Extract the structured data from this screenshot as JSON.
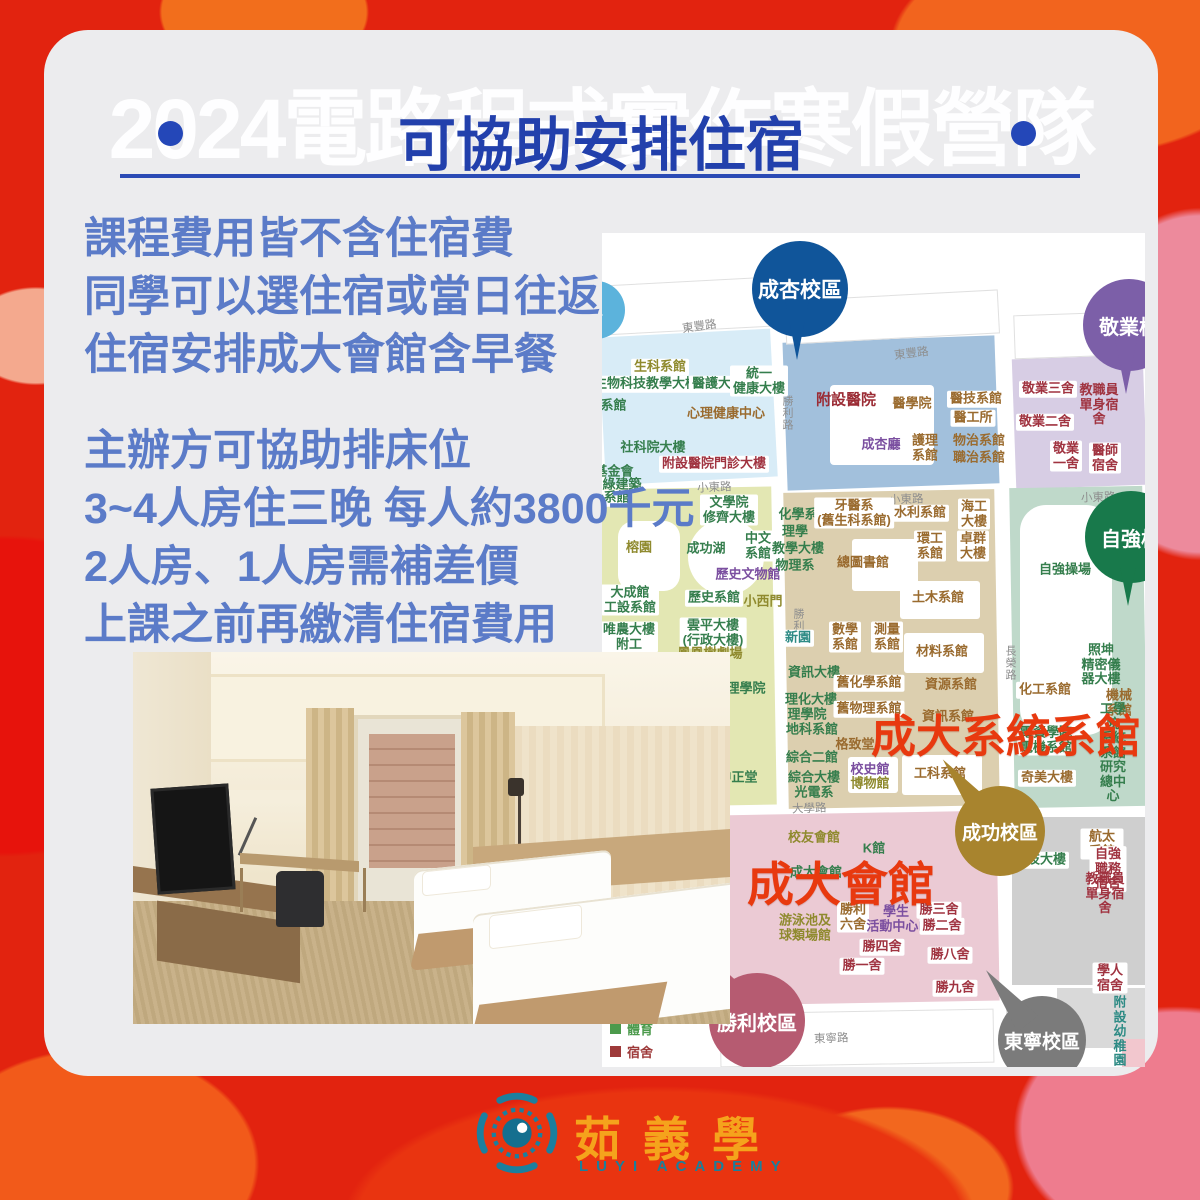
{
  "header": {
    "watermark": "2024電路程式實作寒假營隊",
    "title": "可協助安排住宿"
  },
  "info": {
    "para1": [
      "課程費用皆不含住宿費",
      "同學可以選住宿或當日往返",
      "住宿安排成大會館含早餐"
    ],
    "para2": [
      "主辦方可協助排床位",
      "3~4人房住三晚  每人約3800千元",
      "2人房、1人房需補差價",
      "上課之前再繳清住宿費用"
    ]
  },
  "logo": {
    "name": "茹義學",
    "subtitle": "LUYI ACADEMY",
    "accent": "#F5A31C",
    "teal": "#1B7F9C"
  },
  "colors": {
    "card_bg": "#ECECEE",
    "title_blue": "#2240AC",
    "body_blue": "#5B7BC8",
    "highlight_red": "#E8390F",
    "background_red": "#E2230F"
  },
  "map": {
    "palette": {
      "green": "#357E4D",
      "olive": "#8F8A2E",
      "brown": "#9A6B2F",
      "darkred": "#A03340",
      "purple": "#7B4FA0",
      "teal": "#2E8B85",
      "hospital": "#9B2C35"
    },
    "areas": [
      {
        "x": 0,
        "y": 100,
        "w": 172,
        "h": 148,
        "color": "#D8ECF7",
        "rot": -3
      },
      {
        "x": 183,
        "y": 106,
        "w": 212,
        "h": 148,
        "color": "#A2C0DC",
        "rot": -2
      },
      {
        "x": 412,
        "y": 124,
        "w": 131,
        "h": 130,
        "color": "#D7CDE4",
        "rot": -2
      },
      {
        "x": 0,
        "y": 255,
        "w": 172,
        "h": 318,
        "color": "#E3E7B3",
        "rot": -1
      },
      {
        "x": 184,
        "y": 258,
        "w": 211,
        "h": 316,
        "color": "#DCCFAF",
        "rot": -1
      },
      {
        "x": 410,
        "y": 254,
        "w": 133,
        "h": 320,
        "color": "#BFD9CA",
        "rot": -1
      },
      {
        "x": 410,
        "y": 584,
        "w": 133,
        "h": 168,
        "color": "#CFCFCF",
        "rot": 0
      },
      {
        "x": 116,
        "y": 580,
        "w": 280,
        "h": 190,
        "color": "#EBCAD4",
        "rot": -1
      },
      {
        "x": 455,
        "y": 755,
        "w": 88,
        "h": 60,
        "color": "#D9D9D9",
        "rot": 0
      },
      {
        "x": 520,
        "y": 806,
        "w": 23,
        "h": 28,
        "color": "#F2C7CE",
        "rot": 0
      }
    ],
    "outlines": [
      {
        "x": 0,
        "y": 48,
        "w": 170,
        "h": 48,
        "rot": -3
      },
      {
        "x": 183,
        "y": 62,
        "w": 212,
        "h": 42,
        "rot": -3
      },
      {
        "x": 412,
        "y": 80,
        "w": 131,
        "h": 42,
        "rot": -2
      },
      {
        "x": 118,
        "y": 778,
        "w": 272,
        "h": 52,
        "rot": -1
      },
      {
        "x": 404,
        "y": 772,
        "w": 42,
        "h": 44,
        "rot": 0
      }
    ],
    "shapes": [
      {
        "x": 228,
        "y": 152,
        "w": 104,
        "h": 80,
        "r": 4
      },
      {
        "x": 16,
        "y": 288,
        "w": 62,
        "h": 70,
        "r": 16
      },
      {
        "x": 86,
        "y": 286,
        "w": 76,
        "h": 76,
        "r": 40
      },
      {
        "x": 418,
        "y": 272,
        "w": 92,
        "h": 230,
        "r": 26
      },
      {
        "x": 250,
        "y": 306,
        "w": 66,
        "h": 52,
        "r": 3
      },
      {
        "x": 246,
        "y": 524,
        "w": 50,
        "h": 36,
        "r": 3
      },
      {
        "x": 298,
        "y": 348,
        "w": 80,
        "h": 38,
        "r": 3
      },
      {
        "x": 302,
        "y": 400,
        "w": 80,
        "h": 40,
        "r": 3
      },
      {
        "x": 300,
        "y": 522,
        "w": 80,
        "h": 40,
        "r": 3
      }
    ],
    "roads": [
      {
        "t": "東豐路",
        "x": 80,
        "y": 85,
        "rot": -8
      },
      {
        "t": "東豐路",
        "x": 292,
        "y": 112,
        "rot": -7
      },
      {
        "t": "小東路",
        "x": 95,
        "y": 246,
        "rot": -3
      },
      {
        "t": "小東路",
        "x": 287,
        "y": 258,
        "rot": -2
      },
      {
        "t": "小東路",
        "x": 479,
        "y": 256,
        "rot": -2
      },
      {
        "t": "勝利路",
        "x": 177,
        "y": 162,
        "vert": true
      },
      {
        "t": "勝利路",
        "x": 188,
        "y": 375,
        "vert": true
      },
      {
        "t": "長榮路",
        "x": 400,
        "y": 412,
        "vert": true
      },
      {
        "t": "大學路",
        "x": 190,
        "y": 567,
        "rot": -2
      },
      {
        "t": "東寧路",
        "x": 212,
        "y": 797,
        "rot": -2
      }
    ],
    "pins": [
      {
        "label": "區",
        "x": -6,
        "y": 77,
        "r": 29,
        "color": "#5CB3DC",
        "tail": "none",
        "fs": 14
      },
      {
        "label": "成杏校區",
        "x": 198,
        "y": 56,
        "r": 48,
        "color": "#10559A",
        "tail": "down",
        "fs": 21
      },
      {
        "label": "敬業校",
        "x": 527,
        "y": 92,
        "r": 46,
        "color": "#7C5FA8",
        "tail": "down",
        "fs": 20
      },
      {
        "label": "自強校",
        "x": 529,
        "y": 304,
        "r": 46,
        "color": "#18794B",
        "tail": "down",
        "fs": 20
      },
      {
        "label": "成功校區",
        "x": 398,
        "y": 598,
        "r": 45,
        "color": "#A8842E",
        "tail": "upleft",
        "fs": 19
      },
      {
        "label": "勝利校區",
        "x": 155,
        "y": 788,
        "r": 48,
        "color": "#B65B71",
        "tail": "upleft",
        "fs": 20
      },
      {
        "label": "東寧校區",
        "x": 440,
        "y": 807,
        "r": 44,
        "color": "#7B7B7B",
        "tail": "upleft",
        "fs": 19
      }
    ],
    "overlays": [
      {
        "text": "成大系統系館",
        "x": 269,
        "y": 467,
        "size": 45
      },
      {
        "text": "成大會館",
        "x": 145,
        "y": 613,
        "size": 47
      }
    ],
    "legend": {
      "x": 8,
      "y": 786,
      "items": [
        {
          "label": "體育",
          "color": "#4C9A4C"
        },
        {
          "label": "宿舍",
          "color": "#9E3A3A"
        },
        {
          "label": "其他",
          "color": "#2E8B85"
        }
      ]
    },
    "labels": [
      {
        "t": "生科系館",
        "x": 58,
        "y": 134,
        "c": "olive",
        "bg": true
      },
      {
        "t": "生物科技教學大樓",
        "x": 44,
        "y": 151,
        "c": "green",
        "bg": true
      },
      {
        "t": "醫護大樓",
        "x": 116,
        "y": 151,
        "c": "green",
        "bg": true
      },
      {
        "t": "統一\n健康大樓",
        "x": 157,
        "y": 148,
        "c": "green",
        "bg": true
      },
      {
        "t": "文系館",
        "x": 5,
        "y": 173,
        "c": "green",
        "bg": false
      },
      {
        "t": "心理健康中心",
        "x": 124,
        "y": 181,
        "c": "brown",
        "bg": false
      },
      {
        "t": "社科院大樓",
        "x": 51,
        "y": 215,
        "c": "green",
        "bg": false
      },
      {
        "t": "附設醫院門診大樓",
        "x": 112,
        "y": 231,
        "c": "darkred",
        "bg": true
      },
      {
        "t": "基金會",
        "x": 12,
        "y": 239,
        "c": "green",
        "bg": false
      },
      {
        "t": "綠建築",
        "x": 20,
        "y": 252,
        "c": "green",
        "bg": false
      },
      {
        "t": "附設醫院",
        "x": 244,
        "y": 168,
        "c": "hospital",
        "bg": false,
        "big": true
      },
      {
        "t": "醫學院",
        "x": 310,
        "y": 171,
        "c": "brown",
        "bg": false
      },
      {
        "t": "醫技系館",
        "x": 374,
        "y": 166,
        "c": "brown",
        "bg": true
      },
      {
        "t": "醫工所",
        "x": 371,
        "y": 185,
        "c": "brown",
        "bg": true
      },
      {
        "t": "成杏廳",
        "x": 279,
        "y": 212,
        "c": "purple",
        "bg": false
      },
      {
        "t": "護理\n系館",
        "x": 323,
        "y": 215,
        "c": "brown",
        "bg": false
      },
      {
        "t": "物治系館",
        "x": 377,
        "y": 208,
        "c": "brown",
        "bg": false
      },
      {
        "t": "職治系館",
        "x": 377,
        "y": 225,
        "c": "brown",
        "bg": false
      },
      {
        "t": "敬業三舍",
        "x": 446,
        "y": 156,
        "c": "darkred",
        "bg": true
      },
      {
        "t": "教職員單身宿舍",
        "x": 497,
        "y": 172,
        "c": "darkred",
        "bg": false
      },
      {
        "t": "敬業二舍",
        "x": 443,
        "y": 189,
        "c": "darkred",
        "bg": true
      },
      {
        "t": "敬業\n一舍",
        "x": 464,
        "y": 223,
        "c": "darkred",
        "bg": true
      },
      {
        "t": "醫師\n宿舍",
        "x": 503,
        "y": 225,
        "c": "darkred",
        "bg": true
      },
      {
        "t": "計系館",
        "x": 8,
        "y": 265,
        "c": "green",
        "bg": true
      },
      {
        "t": "文學院\n修齊大樓",
        "x": 127,
        "y": 277,
        "c": "green",
        "bg": true
      },
      {
        "t": "榕園",
        "x": 37,
        "y": 315,
        "c": "olive",
        "bg": false
      },
      {
        "t": "成功湖",
        "x": 104,
        "y": 316,
        "c": "green",
        "bg": false
      },
      {
        "t": "中文\n系館",
        "x": 156,
        "y": 313,
        "c": "green",
        "bg": true
      },
      {
        "t": "歷史文物館",
        "x": 146,
        "y": 342,
        "c": "purple",
        "bg": false
      },
      {
        "t": "大成館\n工設系館",
        "x": 28,
        "y": 367,
        "c": "green",
        "bg": true
      },
      {
        "t": "歷史系館",
        "x": 112,
        "y": 365,
        "c": "green",
        "bg": true
      },
      {
        "t": "小西門",
        "x": 161,
        "y": 369,
        "c": "olive",
        "bg": false
      },
      {
        "t": "唯農大樓\n附工",
        "x": 27,
        "y": 404,
        "c": "green",
        "bg": true
      },
      {
        "t": "雲平大樓\n(行政大樓)",
        "x": 111,
        "y": 400,
        "c": "green",
        "bg": true
      },
      {
        "t": "鳳凰樹劇場",
        "x": 108,
        "y": 421,
        "c": "olive",
        "bg": false
      },
      {
        "t": "理學院",
        "x": 144,
        "y": 456,
        "c": "green",
        "bg": false
      },
      {
        "t": "中正堂",
        "x": 136,
        "y": 545,
        "c": "green",
        "bg": false
      },
      {
        "t": "化學系",
        "x": 196,
        "y": 282,
        "c": "green",
        "bg": false
      },
      {
        "t": "理學",
        "x": 193,
        "y": 299,
        "c": "green",
        "bg": false
      },
      {
        "t": "教學大樓",
        "x": 196,
        "y": 316,
        "c": "green",
        "bg": false
      },
      {
        "t": "物理系",
        "x": 193,
        "y": 333,
        "c": "green",
        "bg": false
      },
      {
        "t": "牙醫系\n(舊生科系館)",
        "x": 252,
        "y": 280,
        "c": "brown",
        "bg": true
      },
      {
        "t": "水利系館",
        "x": 318,
        "y": 280,
        "c": "brown",
        "bg": true
      },
      {
        "t": "海工\n大樓",
        "x": 372,
        "y": 281,
        "c": "brown",
        "bg": true
      },
      {
        "t": "環工\n系館",
        "x": 328,
        "y": 313,
        "c": "brown",
        "bg": true
      },
      {
        "t": "卓群\n大樓",
        "x": 371,
        "y": 313,
        "c": "brown",
        "bg": true
      },
      {
        "t": "總圖書館",
        "x": 261,
        "y": 330,
        "c": "brown",
        "bg": false
      },
      {
        "t": "土木系館",
        "x": 336,
        "y": 365,
        "c": "brown",
        "bg": false
      },
      {
        "t": "新園",
        "x": 196,
        "y": 405,
        "c": "teal",
        "bg": true
      },
      {
        "t": "數學\n系館",
        "x": 243,
        "y": 404,
        "c": "brown",
        "bg": true
      },
      {
        "t": "測量\n系館",
        "x": 285,
        "y": 404,
        "c": "brown",
        "bg": true
      },
      {
        "t": "材料系館",
        "x": 340,
        "y": 419,
        "c": "brown",
        "bg": false
      },
      {
        "t": "資訊大樓",
        "x": 212,
        "y": 440,
        "c": "green",
        "bg": false
      },
      {
        "t": "舊化學系館",
        "x": 267,
        "y": 450,
        "c": "brown",
        "bg": true
      },
      {
        "t": "理化大樓",
        "x": 209,
        "y": 467,
        "c": "green",
        "bg": false
      },
      {
        "t": "理學院",
        "x": 205,
        "y": 482,
        "c": "green",
        "bg": false
      },
      {
        "t": "舊物理系館",
        "x": 267,
        "y": 476,
        "c": "brown",
        "bg": true
      },
      {
        "t": "地科系館",
        "x": 210,
        "y": 497,
        "c": "green",
        "bg": false
      },
      {
        "t": "資源系館",
        "x": 349,
        "y": 452,
        "c": "brown",
        "bg": false
      },
      {
        "t": "資訊系館",
        "x": 346,
        "y": 484,
        "c": "brown",
        "bg": false
      },
      {
        "t": "格致堂",
        "x": 253,
        "y": 512,
        "c": "brown",
        "bg": false
      },
      {
        "t": "綜合二館",
        "x": 210,
        "y": 525,
        "c": "green",
        "bg": false
      },
      {
        "t": "校史館",
        "x": 268,
        "y": 537,
        "c": "purple",
        "bg": false
      },
      {
        "t": "博物館",
        "x": 268,
        "y": 551,
        "c": "olive",
        "bg": false
      },
      {
        "t": "工科系館",
        "x": 338,
        "y": 541,
        "c": "brown",
        "bg": false
      },
      {
        "t": "綜合大樓\n光電系",
        "x": 212,
        "y": 552,
        "c": "green",
        "bg": false
      },
      {
        "t": "自強操場",
        "x": 463,
        "y": 337,
        "c": "green",
        "bg": false
      },
      {
        "t": "照坤\n精密儀器大樓",
        "x": 499,
        "y": 432,
        "c": "green",
        "bg": false
      },
      {
        "t": "化工系館",
        "x": 443,
        "y": 457,
        "c": "brown",
        "bg": true
      },
      {
        "t": "機械系館",
        "x": 517,
        "y": 470,
        "c": "brown",
        "bg": false
      },
      {
        "t": "電資學院\n電機系館",
        "x": 444,
        "y": 507,
        "c": "green",
        "bg": true
      },
      {
        "t": "工學院\n系統系館\n研究總中心",
        "x": 511,
        "y": 520,
        "c": "green",
        "bg": false
      },
      {
        "t": "奇美大樓",
        "x": 445,
        "y": 545,
        "c": "brown",
        "bg": true
      },
      {
        "t": "航太系館",
        "x": 500,
        "y": 611,
        "c": "brown",
        "bg": true
      },
      {
        "t": "科技大樓",
        "x": 438,
        "y": 627,
        "c": "green",
        "bg": true
      },
      {
        "t": "自強職務宿舍",
        "x": 506,
        "y": 636,
        "c": "darkred",
        "bg": true
      },
      {
        "t": "教職員單身宿舍",
        "x": 503,
        "y": 661,
        "c": "darkred",
        "bg": false
      },
      {
        "t": "學人宿舍",
        "x": 508,
        "y": 745,
        "c": "darkred",
        "bg": true
      },
      {
        "t": "附設幼稚園",
        "x": 518,
        "y": 799,
        "c": "teal",
        "bg": false
      },
      {
        "t": "校友會館",
        "x": 212,
        "y": 605,
        "c": "olive",
        "bg": false
      },
      {
        "t": "K館",
        "x": 272,
        "y": 616,
        "c": "green",
        "bg": false
      },
      {
        "t": "成大會館",
        "x": 214,
        "y": 640,
        "c": "green",
        "bg": false
      },
      {
        "t": "游泳池及\n球類場館",
        "x": 203,
        "y": 695,
        "c": "olive",
        "bg": false
      },
      {
        "t": "勝利\n六舍",
        "x": 251,
        "y": 684,
        "c": "brown",
        "bg": true
      },
      {
        "t": "學生\n活動中心II",
        "x": 294,
        "y": 686,
        "c": "purple",
        "bg": false
      },
      {
        "t": "勝三舍",
        "x": 337,
        "y": 677,
        "c": "darkred",
        "bg": true
      },
      {
        "t": "勝二舍",
        "x": 340,
        "y": 693,
        "c": "darkred",
        "bg": true
      },
      {
        "t": "勝四舍",
        "x": 280,
        "y": 714,
        "c": "darkred",
        "bg": true
      },
      {
        "t": "勝八舍",
        "x": 348,
        "y": 722,
        "c": "darkred",
        "bg": true
      },
      {
        "t": "勝一舍",
        "x": 260,
        "y": 733,
        "c": "darkred",
        "bg": true
      },
      {
        "t": "勝九舍",
        "x": 353,
        "y": 755,
        "c": "darkred",
        "bg": true
      }
    ]
  }
}
